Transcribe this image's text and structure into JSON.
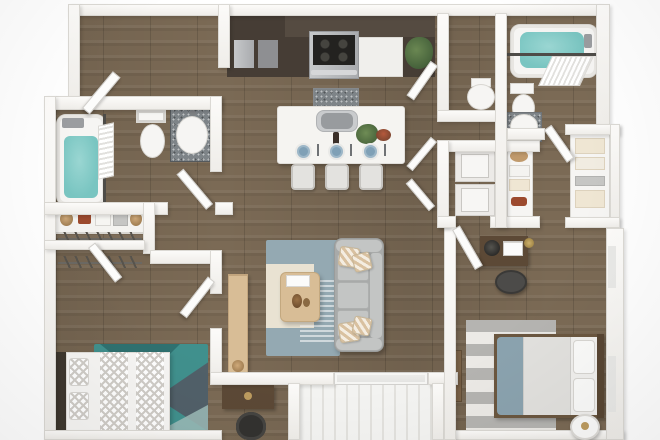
{
  "scene": {
    "type": "3d-floor-plan-render",
    "view": "top-down",
    "description": "Photorealistic top-down 3D rendering of a two-bedroom, two-bathroom apartment floor plan with kitchen island, laundry closet, walk-in closets and a plank-floored balcony",
    "background": "#ffffff"
  },
  "palette": {
    "floor": "#7b6a55",
    "wall": "#f7f5f2",
    "walledge": "#dbd9d4",
    "fixture": "#f6f5f3",
    "water": "#79c5c1",
    "cabinet": "#463d35",
    "cabinet2": "#554b41",
    "cooktop": "#232220",
    "counterwhite": "#f0efec",
    "island": "#f5f4f1",
    "sinkgray": "#9aa0a4",
    "rugteal": "#40908d",
    "rugtealdark": "#2f7170",
    "rugslate": "#525c66",
    "ruglight": "#9dbcb8",
    "rugblue": "#94a9b2",
    "rugcream": "#e9e2d2",
    "sofa": "#a8aaa9",
    "sofalight": "#c3c5c4",
    "pillowstripe": "#d9c1a0",
    "woodlight": "#d8bd96",
    "wooddesk": "#5c4936",
    "chairdark": "#333230",
    "plant": "#5f7d49",
    "plate": "#7fa0b6",
    "deck": "#f4f4f2",
    "deckline": "#e3e2de",
    "linen": "#efe6d3",
    "towelgray": "#c6c6c4",
    "shoered": "#9c4a2e",
    "basket": "#c09a6c",
    "throw": "#8ba3af",
    "rugstripe": "#b5b4b1",
    "rugstripelight": "#eceae6",
    "chevron": "#cfccc7",
    "rod": "#4e4c48"
  },
  "rooms": [
    {
      "id": "entry",
      "fixtures": [
        "open-entry-door"
      ]
    },
    {
      "id": "kitchen",
      "fixtures": [
        "dark-cabinet-run",
        "stainless-range-cooktop",
        "white-counter-section",
        "island-with-sink",
        "three-bar-stools",
        "three-blue-place-settings",
        "wine-bottle",
        "potted-plant",
        "fruit-bowl"
      ]
    },
    {
      "id": "powder-room",
      "fixtures": [
        "toilet",
        "swing-door"
      ]
    },
    {
      "id": "laundry-closet",
      "fixtures": [
        "stacked-washer",
        "stacked-dryer",
        "bifold-doors"
      ]
    },
    {
      "id": "linen-shelves",
      "fixtures": [
        "sun-hat",
        "white-towels",
        "cream-towels",
        "red-shoes"
      ]
    },
    {
      "id": "bathroom-2",
      "fixtures": [
        "filled-bathtub",
        "shower-curtain-rod",
        "shower-curtain",
        "toilet",
        "granite-vanity-sink",
        "swing-door"
      ]
    },
    {
      "id": "hall-closet-bumpout",
      "fixtures": [
        "shelving-with-cream-linens"
      ]
    },
    {
      "id": "bathroom-1",
      "fixtures": [
        "filled-bathtub",
        "shower-curtain-rod",
        "shower-curtain",
        "toilet",
        "granite-vanity-sink",
        "swing-door"
      ]
    },
    {
      "id": "hall-shelf-closet",
      "fixtures": [
        "woven-baskets",
        "red-shoes",
        "folded-white-towels",
        "folded-gray-towels",
        "hanging-rod"
      ]
    },
    {
      "id": "walk-in-closet",
      "fixtures": [
        "hanging-rod-with-hangers",
        "swing-door"
      ]
    },
    {
      "id": "bedroom-1",
      "fixtures": [
        "bed-chevron-bedding",
        "two-pillows",
        "teal-geometric-rug",
        "dark-desk",
        "desk-chair",
        "swing-door"
      ]
    },
    {
      "id": "living-room",
      "fixtures": [
        "gray-sofa",
        "striped-accent-pillows",
        "oak-coffee-table",
        "oak-media-console",
        "two-tone-blue-cream-rug"
      ]
    },
    {
      "id": "bedroom-2",
      "fixtures": [
        "bed-with-blue-throw",
        "two-white-pillows",
        "gray-striped-rug",
        "desk-with-lamp-and-laptop",
        "desk-chair",
        "wood-bench",
        "round-side-table",
        "swing-door",
        "windows"
      ]
    },
    {
      "id": "balcony",
      "fixtures": [
        "white-plank-decking",
        "sliding-glass-door"
      ]
    }
  ]
}
